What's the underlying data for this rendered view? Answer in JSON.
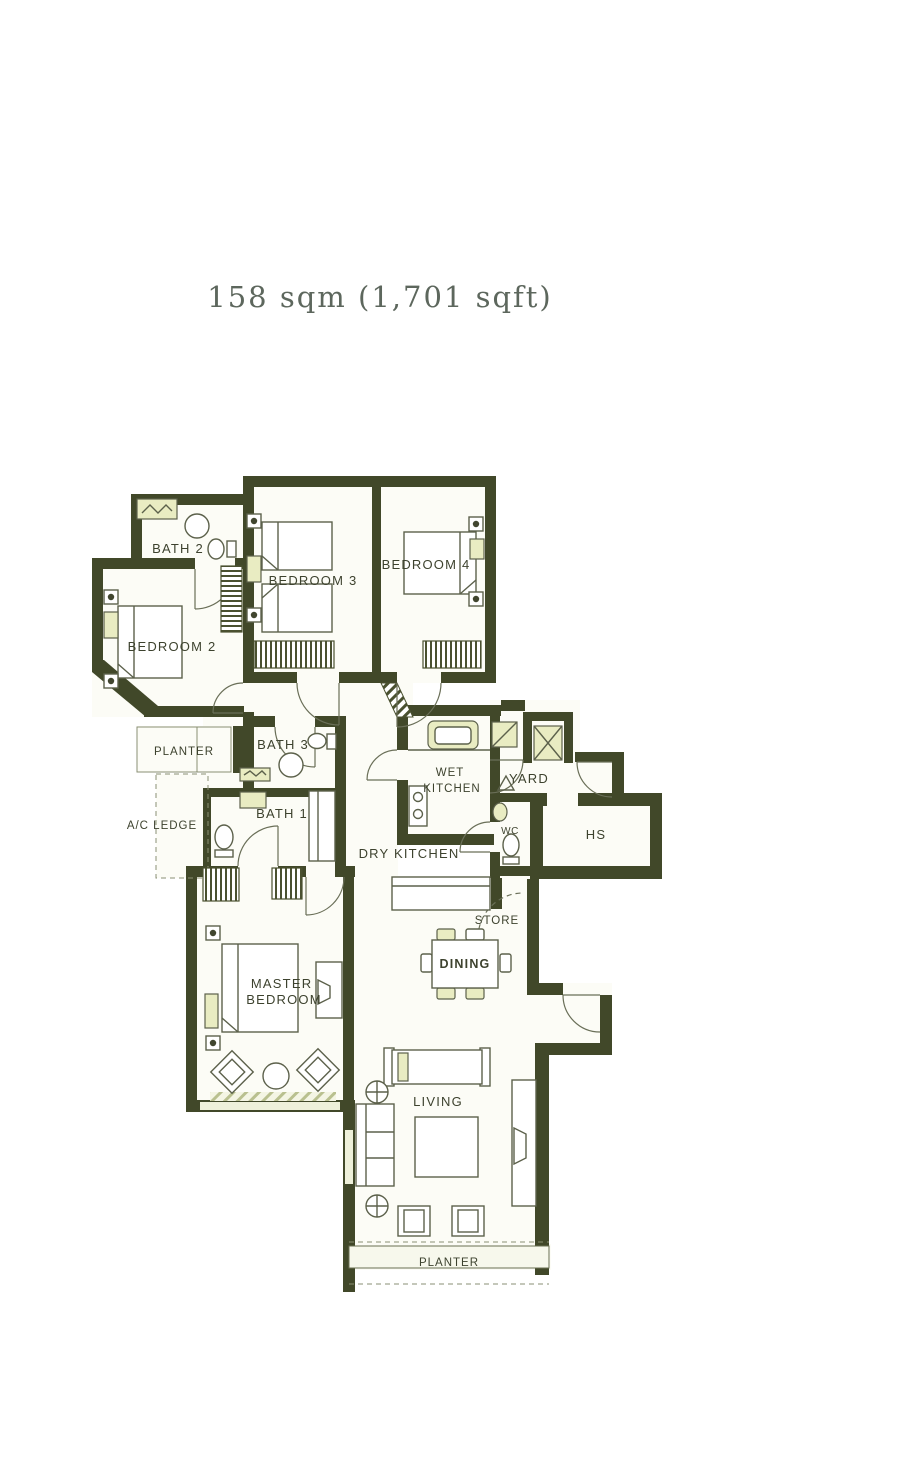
{
  "title": "158 sqm (1,701 sqft)",
  "rooms": {
    "bath2": {
      "label": "BATH 2"
    },
    "bedroom2": {
      "label": "BEDROOM 2"
    },
    "bedroom3": {
      "label": "BEDROOM 3"
    },
    "bedroom4": {
      "label": "BEDROOM 4"
    },
    "planter_top": {
      "label": "PLANTER"
    },
    "bath3": {
      "label": "BATH 3"
    },
    "ac_ledge": {
      "label": "A/C LEDGE"
    },
    "bath1": {
      "label": "BATH 1"
    },
    "wet_kitchen": {
      "lines": [
        "WET",
        "KITCHEN"
      ]
    },
    "yard": {
      "label": "YARD"
    },
    "dry_kitchen": {
      "label": "DRY KITCHEN"
    },
    "wc": {
      "label": "WC"
    },
    "hs": {
      "label": "HS"
    },
    "store": {
      "label": "STORE"
    },
    "dining": {
      "label": "DINING"
    },
    "master_bedroom": {
      "lines": [
        "MASTER",
        "BEDROOM"
      ]
    },
    "living": {
      "label": "LIVING"
    },
    "planter_bottom": {
      "label": "PLANTER"
    }
  },
  "colors": {
    "wall": "#414829",
    "accent": "#e9ecc2",
    "line": "#5c614b",
    "label": "#3d422e",
    "title": "#5d675d"
  }
}
